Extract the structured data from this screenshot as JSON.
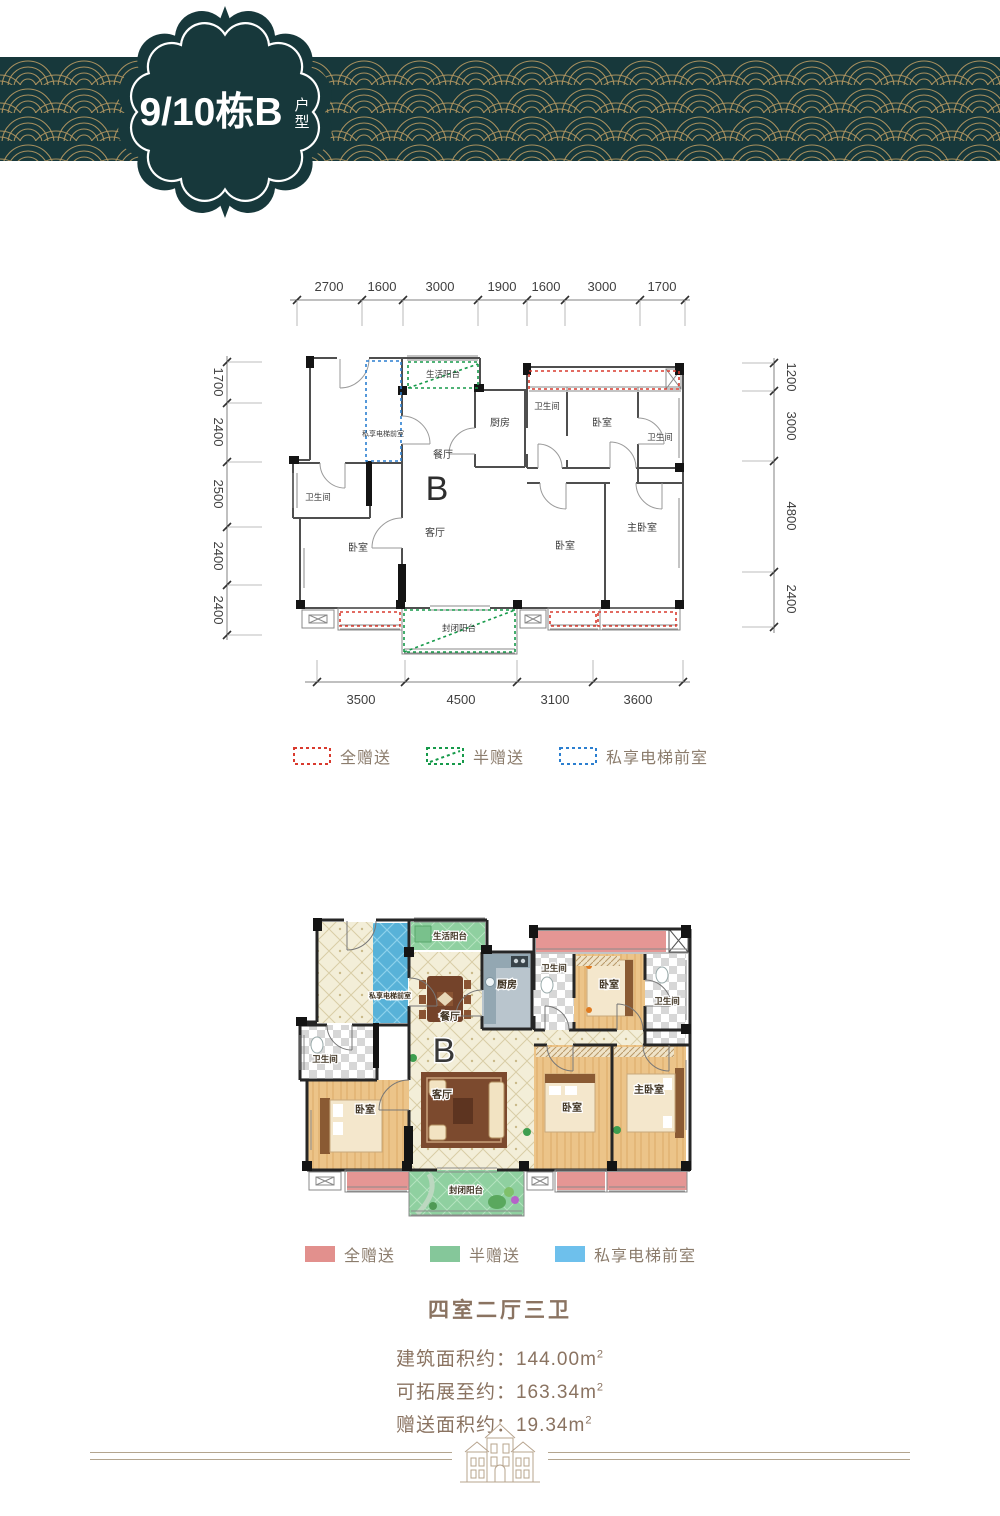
{
  "header": {
    "badge_title": "9/10栋B",
    "badge_sub_top": "户",
    "badge_sub_bottom": "型",
    "band_color": "#17383b",
    "gold_color": "#b89a62"
  },
  "rooms": {
    "service_balcony": "生活阳台",
    "private_lobby": "私享电梯前室",
    "kitchen": "厨房",
    "bathroom": "卫生间",
    "bedroom": "卧室",
    "dining": "餐厅",
    "living": "客厅",
    "master_bedroom": "主卧室",
    "closed_balcony": "封闭阳台",
    "unit_letter": "B"
  },
  "tech_plan": {
    "dims_top": [
      "2700",
      "1600",
      "3000",
      "1900",
      "1600",
      "3000",
      "1700"
    ],
    "dims_left": [
      "1700",
      "2400",
      "2500",
      "2400",
      "2400"
    ],
    "dims_right": [
      "1200",
      "3000",
      "4800",
      "2400"
    ],
    "dims_bottom": [
      "3500",
      "4500",
      "3100",
      "3600"
    ]
  },
  "legend_dotted": {
    "items": [
      {
        "label": "全赠送",
        "color": "#d93a2e"
      },
      {
        "label": "半赠送",
        "color": "#169a4a"
      },
      {
        "label": "私享电梯前室",
        "color": "#2b7fd0"
      }
    ]
  },
  "legend_solid": {
    "items": [
      {
        "label": "全赠送",
        "color": "#e2908d"
      },
      {
        "label": "半赠送",
        "color": "#85c79a"
      },
      {
        "label": "私享电梯前室",
        "color": "#6ec0ec"
      }
    ]
  },
  "info": {
    "layout_title": "四室二厅三卫",
    "lines": [
      {
        "text": "建筑面积约：144.00m",
        "sup": "2"
      },
      {
        "text": "可拓展至约：163.34m",
        "sup": "2"
      },
      {
        "text": "赠送面积约：19.34m",
        "sup": "2"
      }
    ]
  }
}
